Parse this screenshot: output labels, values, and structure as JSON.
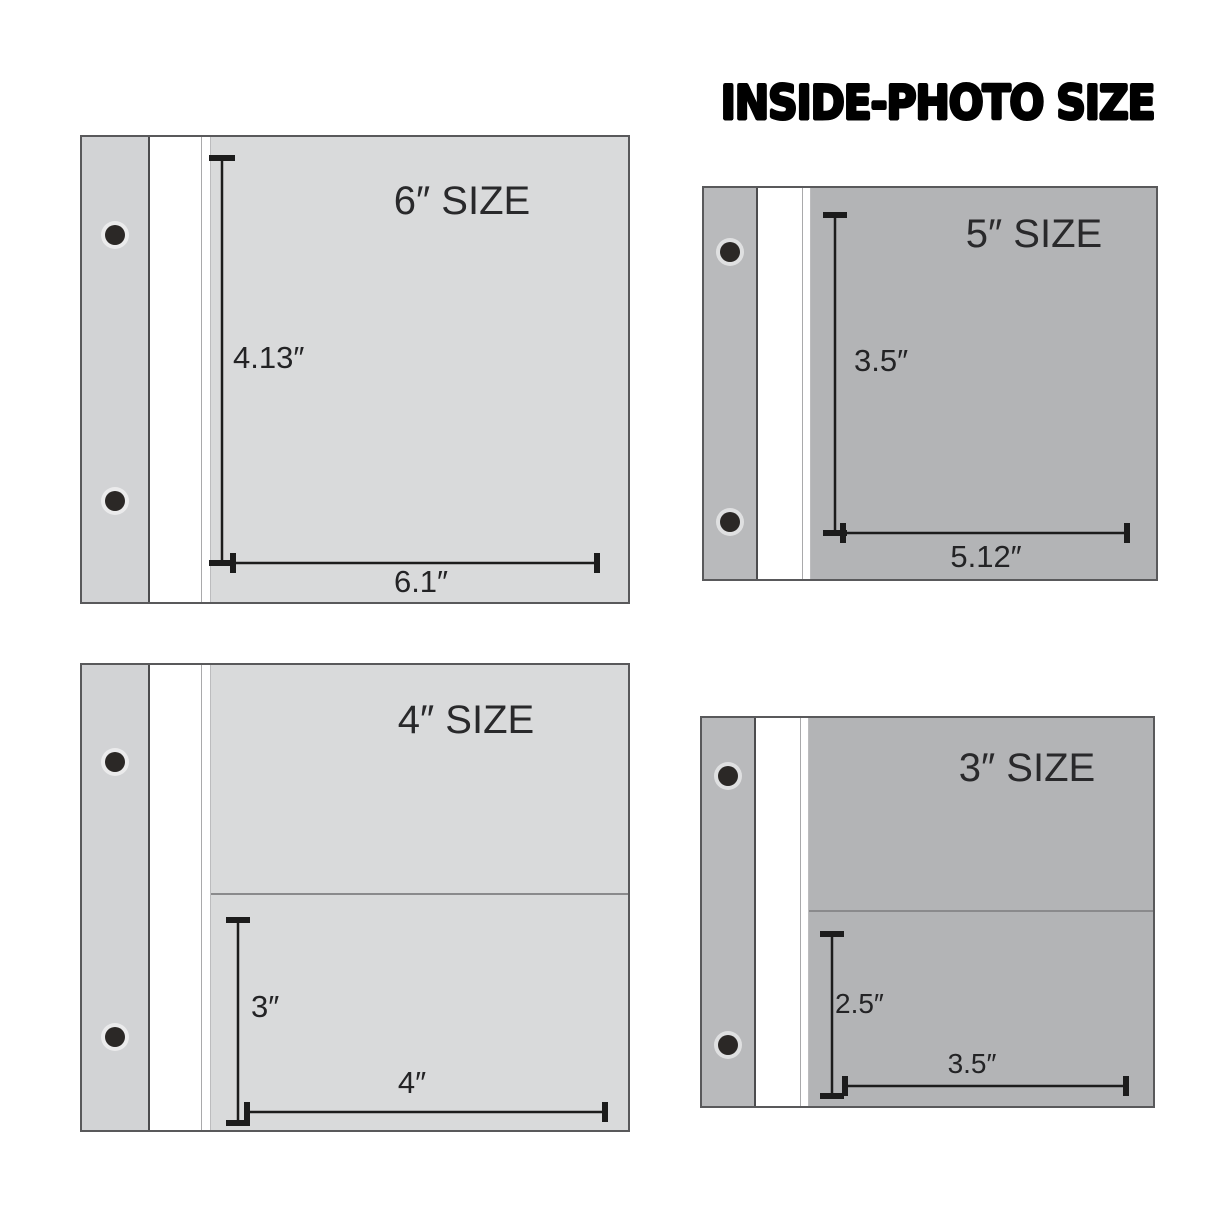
{
  "header": {
    "title": "INSIDE-PHOTO SIZE"
  },
  "colors": {
    "background": "#ffffff",
    "light_page_gray": "#d9dadb",
    "light_binding_gray": "#d2d3d5",
    "dark_page_gray": "#b3b4b6",
    "dark_binding_gray": "#b9babc",
    "spine_white": "#ffffff",
    "panel_border": "#59595b",
    "pocket_divider": "#8a8a8c",
    "dimension_line": "#1c1c1c",
    "hole_black": "#2b2826"
  },
  "panels": [
    {
      "id": "6-inch",
      "title": "6″ SIZE",
      "photo_height": "4.13″",
      "photo_width": "6.1″",
      "pockets": 1,
      "shade": "light"
    },
    {
      "id": "5-inch",
      "title": "5″ SIZE",
      "photo_height": "3.5″",
      "photo_width": "5.12″",
      "pockets": 1,
      "shade": "dark"
    },
    {
      "id": "4-inch",
      "title": "4″ SIZE",
      "photo_height": "3″",
      "photo_width": "4″",
      "pockets": 2,
      "shade": "light"
    },
    {
      "id": "3-inch",
      "title": "3″ SIZE",
      "photo_height": "2.5″",
      "photo_width": "3.5″",
      "pockets": 2,
      "shade": "dark"
    }
  ]
}
